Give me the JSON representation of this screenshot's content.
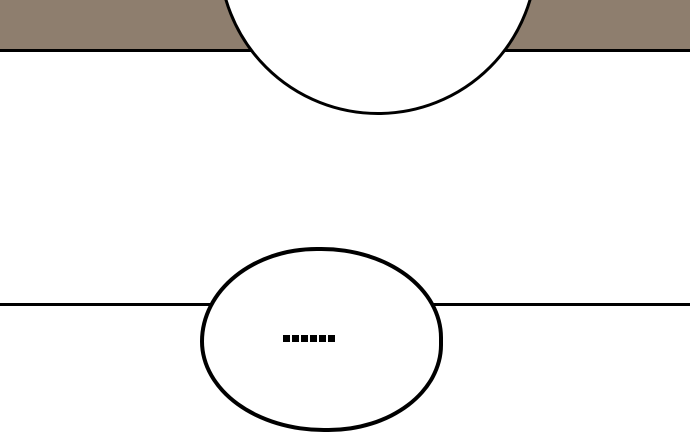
{
  "panel": {
    "type": "comic-panel",
    "background_color": "#ffffff",
    "ink_color": "#000000",
    "top_scene": {
      "band_color": "#8e7e6e",
      "bubble_text": ""
    },
    "bottom_scene": {
      "bubble_text": "......"
    }
  }
}
